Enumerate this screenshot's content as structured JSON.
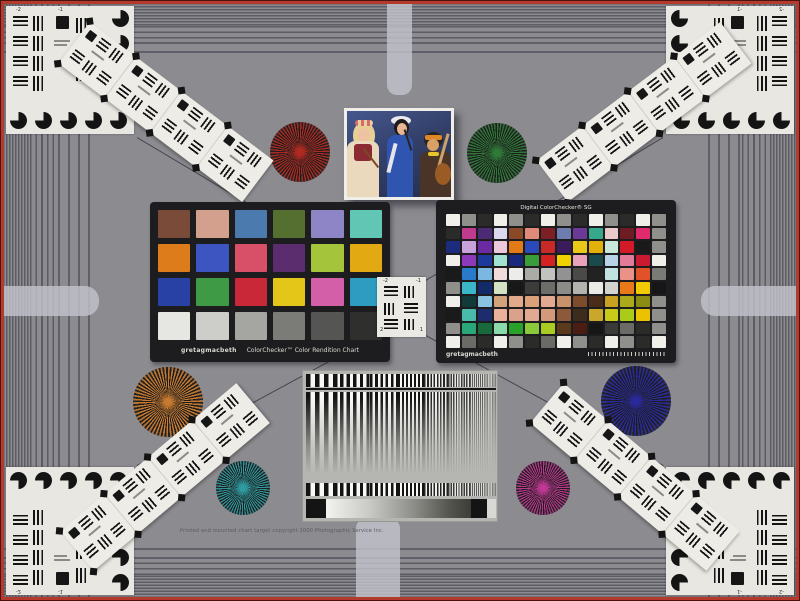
{
  "scene": {
    "description": "Combined camera test chart: color checkers, Siemens stars, resolution wedges, frequency sweep",
    "background": "#8b8b90",
    "frame_color": "#b53a2e",
    "band_line_color": "#5c5c64",
    "tab_color": "#c2c2cc"
  },
  "classic": {
    "brand": "gretagmacbeth",
    "title": "ColorChecker™ Color Rendition Chart",
    "frame_color": "#1d1d1f",
    "patches": [
      "#7a4b39",
      "#d2a08c",
      "#4a7aae",
      "#546f2f",
      "#8d85c5",
      "#62c6b5",
      "#dd7c1b",
      "#3c55c0",
      "#d85068",
      "#5b2d6e",
      "#a4c43c",
      "#e2a912",
      "#2741a5",
      "#3f9a45",
      "#c92839",
      "#e3c618",
      "#d35fa8",
      "#2e9bc1",
      "#e6e6e3",
      "#cdcdc9",
      "#a5a5a2",
      "#7b7b78",
      "#555553",
      "#2f2f2d"
    ]
  },
  "sg": {
    "title": "Digital ColorChecker® SG",
    "brand": "gretagmacbeth",
    "frame_color": "#1d1d1f",
    "rows": [
      [
        "#f0efe9",
        "#8f8f8b",
        "#2b2b29",
        "#f0efe9",
        "#8f8f8b",
        "#2b2b29",
        "#f0efe9",
        "#8f8f8b",
        "#2b2b29",
        "#f0efe9",
        "#8f8f8b",
        "#2b2b29",
        "#f0efe9",
        "#8f8f8b"
      ],
      [
        "#2b2b29",
        "#c03a8e",
        "#4c2a74",
        "#dcd9ee",
        "#8a4a28",
        "#e28a7a",
        "#7c2026",
        "#6e7cb0",
        "#6c3a96",
        "#38a88c",
        "#eccaca",
        "#6e1c22",
        "#e02a6e",
        "#8f8f8b"
      ],
      [
        "#1c2c7c",
        "#c8a2da",
        "#6c2aa2",
        "#ecc8da",
        "#e27a18",
        "#2a4aba",
        "#c82a28",
        "#3a1c5c",
        "#eac81a",
        "#e2b20a",
        "#c8e8dc",
        "#d21a28",
        "#1a1a1a",
        "#8f8f8b"
      ],
      [
        "#f0efe9",
        "#8c3aba",
        "#1c3a9c",
        "#a2e2d2",
        "#18287c",
        "#3a9c3a",
        "#d22222",
        "#f0d202",
        "#eaa2ba",
        "#1a4a4c",
        "#b8d2e8",
        "#e27a9a",
        "#ca1a32",
        "#f0efe9"
      ],
      [
        "#1a1a1a",
        "#2a7aca",
        "#7ab8e2",
        "#f0dada",
        "#ececea",
        "#aaaaa6",
        "#c2c2be",
        "#929292",
        "#4a4a48",
        "#222222",
        "#c2e2e2",
        "#ea9288",
        "#e25228",
        "#7a7a76"
      ],
      [
        "#8f8f8b",
        "#3ab8ca",
        "#122a6a",
        "#d2e2c2",
        "#181818",
        "#3c3c3a",
        "#6c6c68",
        "#8c8c88",
        "#b2b2ae",
        "#eaeae6",
        "#d2d2ce",
        "#ea7a18",
        "#f2ca02",
        "#161616"
      ],
      [
        "#f0efe9",
        "#123a3a",
        "#8ac2e2",
        "#d2a27a",
        "#e2aa8a",
        "#daa07a",
        "#e2aa92",
        "#ca926a",
        "#7c4c2c",
        "#4a2c1a",
        "#caa222",
        "#aaaa1a",
        "#8c8c12",
        "#8f8f8b"
      ],
      [
        "#1a1a1a",
        "#4abaaa",
        "#1c2c6c",
        "#eab29a",
        "#daa28a",
        "#e2aa92",
        "#d29a7a",
        "#8c5a3a",
        "#3c2c1c",
        "#caa62a",
        "#cac91a",
        "#aacb1a",
        "#eac202",
        "#8f8f8b"
      ],
      [
        "#8f8f8b",
        "#2aa87a",
        "#186a3a",
        "#8adaaa",
        "#28a228",
        "#8aca3a",
        "#aacb22",
        "#5a3a1a",
        "#4a1c12",
        "#161616",
        "#3a3a38",
        "#6a6a66",
        "#2b2b29",
        "#8f8f8b"
      ],
      [
        "#f0efe9",
        "#6a6a66",
        "#2b2b29",
        "#f0efe9",
        "#8f8f8b",
        "#2b2b29",
        "#6a6a66",
        "#f0efe9",
        "#8f8f8b",
        "#2b2b29",
        "#f0efe9",
        "#8f8f8b",
        "#2b2b29",
        "#f0efe9"
      ]
    ]
  },
  "stars": [
    {
      "name": "red",
      "color": "#b02a22",
      "x": 300,
      "y": 152,
      "r": 30
    },
    {
      "name": "green",
      "color": "#2f7a38",
      "x": 497,
      "y": 153,
      "r": 30
    },
    {
      "name": "orange",
      "color": "#c87a30",
      "x": 168,
      "y": 402,
      "r": 35
    },
    {
      "name": "blue",
      "color": "#2a2a9e",
      "x": 636,
      "y": 401,
      "r": 35
    },
    {
      "name": "teal",
      "color": "#2f9aa0",
      "x": 243,
      "y": 488,
      "r": 27
    },
    {
      "name": "magenta",
      "color": "#c03892",
      "x": 543,
      "y": 488,
      "r": 27
    }
  ],
  "mini": {
    "labels": [
      "-2",
      "-1",
      "2",
      "1"
    ]
  },
  "corner": {
    "labels": [
      "-2",
      "-1"
    ]
  },
  "photo": {
    "background_top": "#46588e",
    "background_bottom": "#262e4c",
    "border": "#efeee8",
    "subjects": "three costumed musicians with instruments"
  },
  "sweep": {
    "panel_bg": "#b5b5b1",
    "dark": "#1c1c1c",
    "light": "#f2f2ee"
  },
  "copyright": "Printed and mounted chart target copyright 2000 Photographic Service Inc."
}
